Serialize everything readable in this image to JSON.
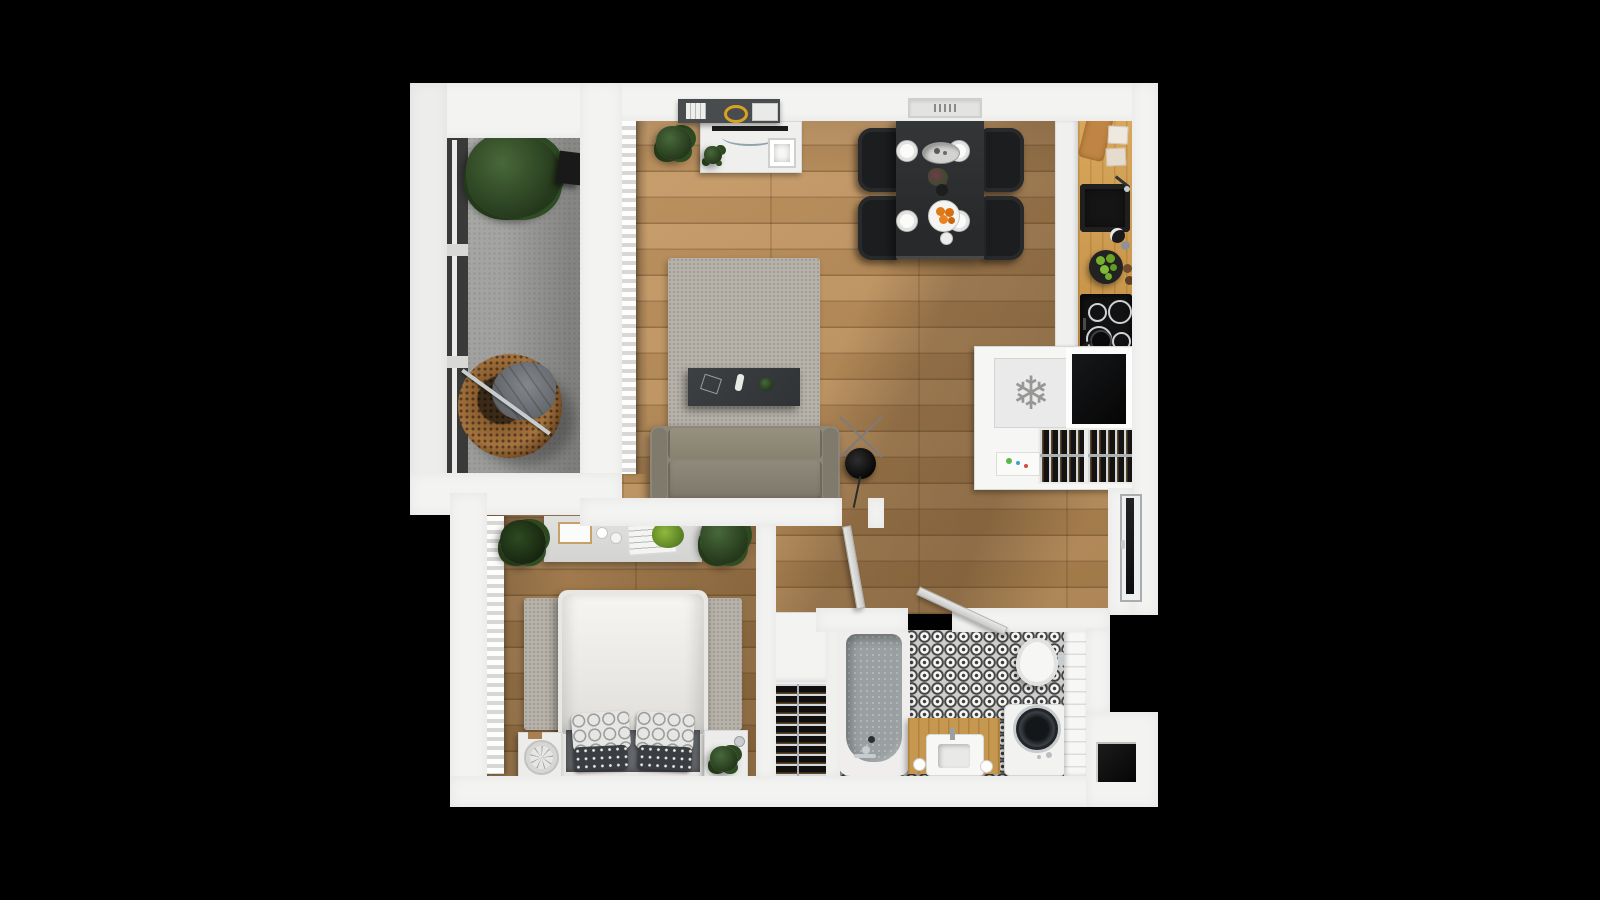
{
  "scene": {
    "description": "Top-down 3D rendered floor plan of a one-bedroom apartment on a black background",
    "background_color": "#000000"
  },
  "palette": {
    "wall_white": "#f3f3f2",
    "wood_floor": "#b78c5a",
    "kitchen_counter_wood": "#cf9e52",
    "balcony_concrete": "#a3a3a1",
    "sofa_taupe": "#8d8679",
    "black_furniture": "#1d1f21",
    "rug_gray": "#b6b2a9",
    "tub_gray": "#9aa0a2",
    "tile_dark": "#474747",
    "apple_green": "#76b02c",
    "orange_fruit": "#e07a18"
  },
  "icons": {
    "freezer_snowflake": "❄"
  },
  "rooms": [
    {
      "id": "balcony",
      "name": "balcony",
      "furniture": [
        "potted plant",
        "hanging egg chair",
        "black side table",
        "floor-to-ceiling window"
      ]
    },
    {
      "id": "living-room",
      "name": "living room",
      "furniture": [
        "wall shelf with books",
        "tv console",
        "tv",
        "area rug",
        "coffee table",
        "three-seat sofa",
        "tripod floor lamp",
        "sheer curtains",
        "potted plant"
      ]
    },
    {
      "id": "dining-area",
      "name": "dining area",
      "furniture": [
        "black dining table",
        "four black chairs",
        "four place settings",
        "serving platter",
        "flower vase",
        "plate of oranges",
        "wall vent"
      ]
    },
    {
      "id": "kitchen",
      "name": "kitchen",
      "furniture": [
        "wood counter",
        "cutting board",
        "black sink",
        "induction cooktop with pan",
        "bowl of green apples",
        "kiwis",
        "fridge-freezer",
        "open black compartment",
        "wine rack",
        "small boxes"
      ]
    },
    {
      "id": "hallway",
      "name": "hallway",
      "furniture": [
        "entry door",
        "storage cabinet",
        "wine rack",
        "bedroom door (open)",
        "bathroom door (open)"
      ]
    },
    {
      "id": "bedroom",
      "name": "bedroom",
      "furniture": [
        "double bed",
        "patterned pillows",
        "area rug",
        "dresser with frame, cups and papers",
        "two nightstands",
        "table fan",
        "three potted plants",
        "vertical blinds"
      ]
    },
    {
      "id": "bathroom",
      "name": "bathroom",
      "furniture": [
        "bathtub",
        "wood vanity with sink",
        "toilet",
        "washing machine",
        "patterned cement tile floor",
        "white tiled wall"
      ]
    }
  ]
}
